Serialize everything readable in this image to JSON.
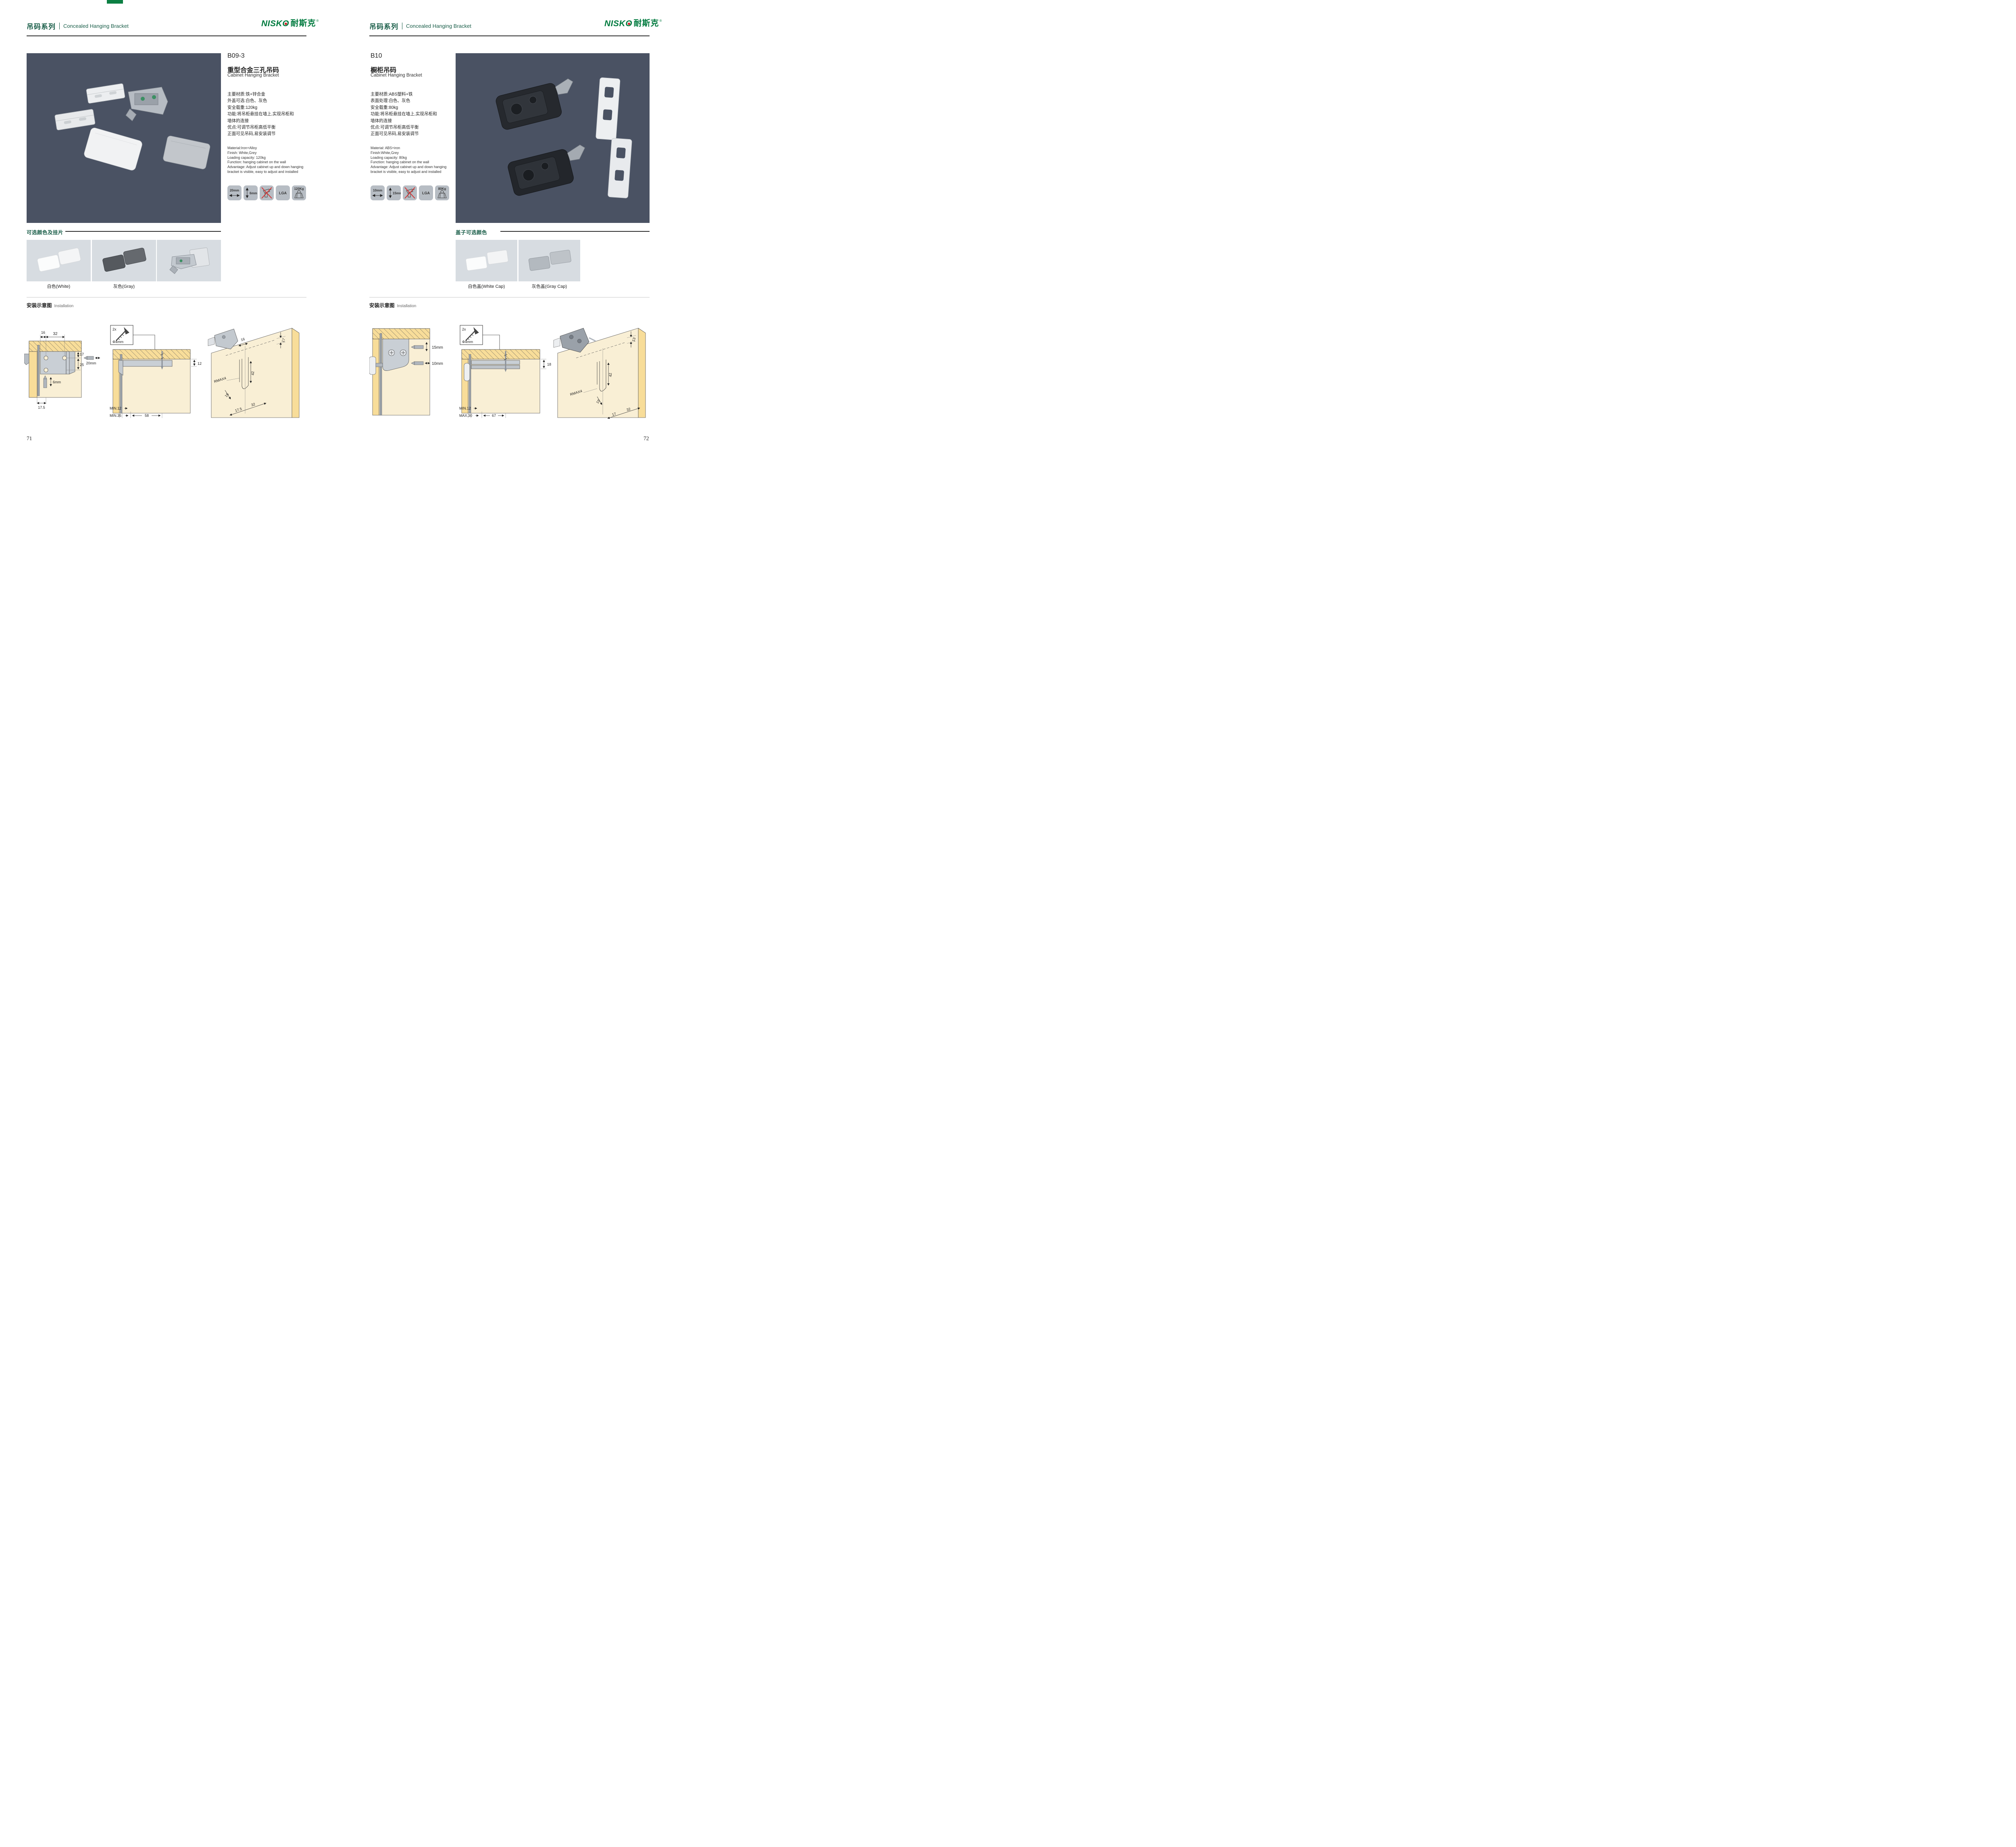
{
  "brand": {
    "logo_latin": "NISK",
    "logo_o": "O",
    "logo_cn": "耐斯克",
    "registered": "®"
  },
  "colors": {
    "brand_green": "#007b3f",
    "heading_green": "#1a5e49",
    "photo_bg": "#4a5263",
    "badge_gray": "#b7bdc4",
    "swatch_bg": "#d7dce1",
    "no_drill_red": "#d row33"
  },
  "pages": [
    {
      "number": "71",
      "header": {
        "series_cn": "吊码系列",
        "series_en": "Concealed Hanging Bracket"
      },
      "product": {
        "code": "B09-3",
        "name_cn": "重型合金三孔吊码",
        "name_en": "Cabinet Hanging Bracket",
        "specs_cn": [
          "主要材质:铁+锌合金",
          "外盖可选:白色、灰色",
          "安全载重:120kg",
          "功能:将吊柜悬挂在墙上,实现吊柜和",
          "墙体的连接",
          "优点:可调节吊柜高低平衡",
          "正面可见吊码,易安装调节"
        ],
        "specs_en": [
          "Material:Iron+Alloy",
          "Finish: White,Grey",
          "Loading capacity: 120kg",
          "Function: hanging cabinet on the wall",
          "Advantage: Adjust cabinet up and down hanging",
          "bracket is visible, easy to adjust and installed"
        ]
      },
      "badges": {
        "width": "20mm",
        "height": "6mm",
        "cert": "LGA",
        "load": "120Kg"
      },
      "colors_section": {
        "heading": "可选颜色及挂片",
        "caption1": "白色(White)",
        "caption2": "灰色(Gray)"
      },
      "installation": {
        "heading_cn": "安装示意图",
        "heading_en": "Installation",
        "screw_count": "2x",
        "screw_dia": "Φ4mm",
        "d1": {
          "w1": "16",
          "w2": "32",
          "h1": "17",
          "h2": "25",
          "side": "20mm",
          "depth": "6mm",
          "b1": "17.5"
        },
        "d2": {
          "t": "12",
          "m1": "MIN.12",
          "m2": "MIN.35",
          "span": "58"
        },
        "d3": {
          "a": "16",
          "b": "17",
          "c": "42",
          "r": "RMAX4",
          "d": "16",
          "e": "17.5",
          "f": "32"
        }
      }
    },
    {
      "number": "72",
      "header": {
        "series_cn": "吊码系列",
        "series_en": "Concealed Hanging Bracket"
      },
      "product": {
        "code": "B10",
        "name_cn": "橱柜吊码",
        "name_en": "Cabinet Hanging Bracket",
        "specs_cn": [
          "主要材质:ABS塑料+铁",
          "表面处理:白色、灰色",
          "安全载重:80kg",
          "功能:将吊柜悬挂在墙上,实现吊柜和",
          "墙体的连接",
          "优点:可调节吊柜高低平衡",
          "正面可见吊码,易安装调节"
        ],
        "specs_en": [
          "Material: ABS+iron",
          "Finish:White,Grey",
          "Loading capacity: 80kg",
          "Function: hanging cabinet on the wall",
          "Advantage: Adjust cabinet up and down hanging",
          "bracket is visible, easy to adjust and installed"
        ]
      },
      "badges": {
        "width": "10mm",
        "height": "15mm",
        "cert": "LGA",
        "load": "80Kg"
      },
      "colors_section": {
        "heading": "盖子可选颜色",
        "caption1": "白色盖(White Cap)",
        "caption2": "灰色盖(Gray Cap)"
      },
      "installation": {
        "heading_cn": "安装示意图",
        "heading_en": "Installation",
        "screw_count": "2x",
        "screw_dia": "Φ4mm",
        "d1": {
          "v": "15mm",
          "h": "10mm"
        },
        "d2": {
          "t": "18",
          "m1": "MIN.12",
          "m2": "MAX.30",
          "span": "67"
        },
        "d3": {
          "a": "13",
          "c": "42",
          "r": "RMAX4",
          "d": "19",
          "e": "17",
          "f": "32"
        }
      }
    }
  ]
}
